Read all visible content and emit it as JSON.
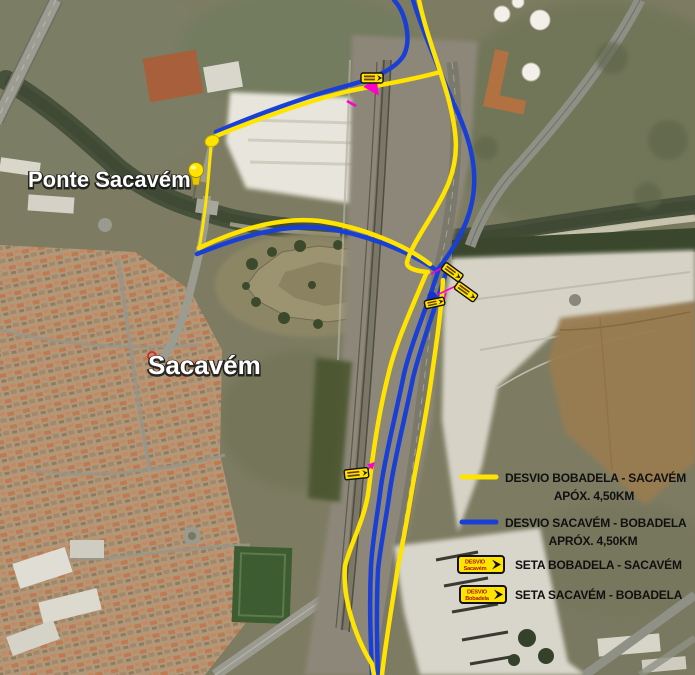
{
  "map": {
    "place_labels": [
      {
        "text": "Ponte Sacavém"
      },
      {
        "text": "Sacavém"
      }
    ],
    "icons": [
      {
        "name": "pushpin-icon",
        "color": "#ffe400"
      },
      {
        "name": "roundabout-dot",
        "color": "#ffe400"
      },
      {
        "name": "junction-dot",
        "color": "#1334c8"
      },
      {
        "name": "red-marker",
        "color": "#d03030"
      },
      {
        "name": "arrow-sign-plate",
        "count": 5,
        "color": "#ffe400"
      }
    ]
  },
  "legend": {
    "items": [
      {
        "swatch": "line",
        "color": "#ffe400",
        "label": "DESVIO BOBADELA - SACAVÉM",
        "sublabel": "APÓX. 4,50KM"
      },
      {
        "swatch": "line",
        "color": "#1a3fd4",
        "label": "DESVIO SACAVÉM - BOBADELA",
        "sublabel": "APRÓX. 4,50KM"
      },
      {
        "swatch": "sign",
        "sign_line1": "DESVIO",
        "sign_line2": "Sacavém",
        "label": "SETA BOBADELA - SACAVÉM"
      },
      {
        "swatch": "sign",
        "sign_line1": "DESVIO",
        "sign_line2": "Bobadela",
        "label": "SETA SACAVÉM - BOBADELA"
      }
    ]
  },
  "colors": {
    "route_yellow": "#ffe400",
    "route_blue": "#1a3fd4",
    "callout_magenta": "#ff00c8",
    "label_text": "#ffffff",
    "legend_text": "#111111"
  }
}
